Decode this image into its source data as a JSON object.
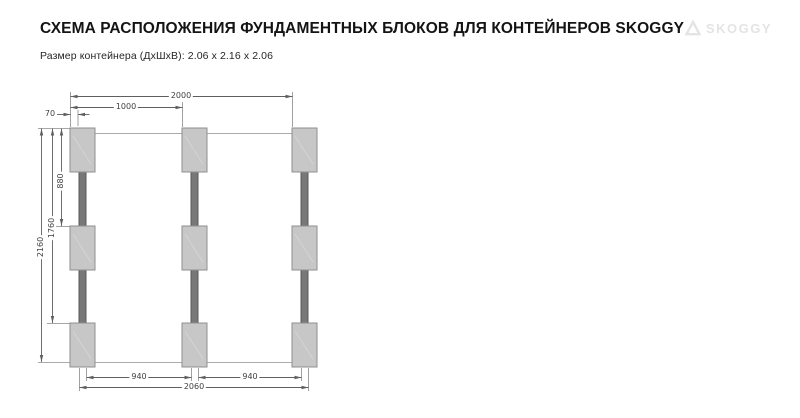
{
  "header": {
    "title": "СХЕМА РАСПОЛОЖЕНИЯ ФУНДАМЕНТНЫХ БЛОКОВ ДЛЯ КОНТЕЙНЕРОВ SKOGGY",
    "subtitle": "Размер контейнера (ДхШхВ): 2.06 x 2.16 x 2.06",
    "logo": {
      "text": "SKOGGY"
    }
  },
  "diagram": {
    "description": "Plan view of 9 foundation blocks arranged 3 rows x 3 columns, columns joined by rails",
    "grid": {
      "rows": 3,
      "columns": 3
    },
    "dimensions_mm": {
      "top_overall": "2000",
      "top_half": "1000",
      "edge_offset": "70",
      "vertical_to_mid_row": "880",
      "vertical_to_bottom_row": "1760",
      "vertical_overall": "2160",
      "bottom_gap_left": "940",
      "bottom_gap_right": "940",
      "bottom_overall": "2060"
    },
    "colors": {
      "block_fill": "#c7c7c7",
      "block_border": "#8f8f8f",
      "rail_fill": "#787878",
      "dimension_line": "#5f5f5f",
      "outline_line": "#ababab",
      "dimension_text": "#3f3f3f"
    }
  }
}
